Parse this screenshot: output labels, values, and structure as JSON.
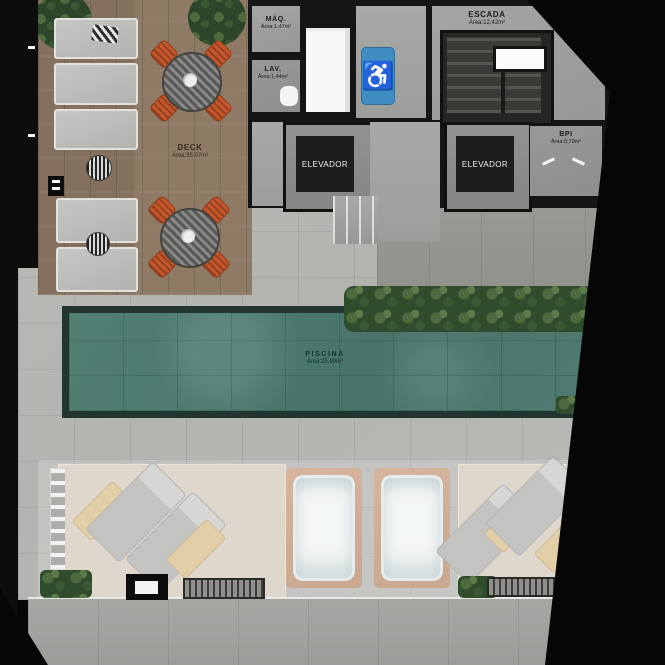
{
  "plan": {
    "type": "rooftop floor plan",
    "rooms": {
      "deck": {
        "name": "DECK",
        "area": "Área:35,07m²"
      },
      "maq": {
        "name": "MÁQ.",
        "area": "Área:1,47m²"
      },
      "lav": {
        "name": "LAV.",
        "area": "Área:1,44m²"
      },
      "escada": {
        "name": "ESCADA",
        "area": "Área:12,42m²"
      },
      "bpi": {
        "name": "BPI",
        "area": "Área:0,79m²"
      },
      "piscina": {
        "name": "PISCINA",
        "area": "Área:25,99m²"
      },
      "elevator_left": {
        "name": "ELEVADOR"
      },
      "elevator_right": {
        "name": "ELEVADOR"
      }
    },
    "icons": {
      "accessibility": "♿"
    },
    "colors": {
      "pool_water": "#4d7b70",
      "pool_border": "#233530",
      "deck_wood": "#8b7663",
      "pavement": "#b6b7b3",
      "accessibility_blue": "#3f8dc1",
      "chair_orange": "#c4562a",
      "hedge_green": "#3d5a35",
      "hot_tub_frame": "#c59b7e",
      "wall_black": "#151515"
    }
  }
}
